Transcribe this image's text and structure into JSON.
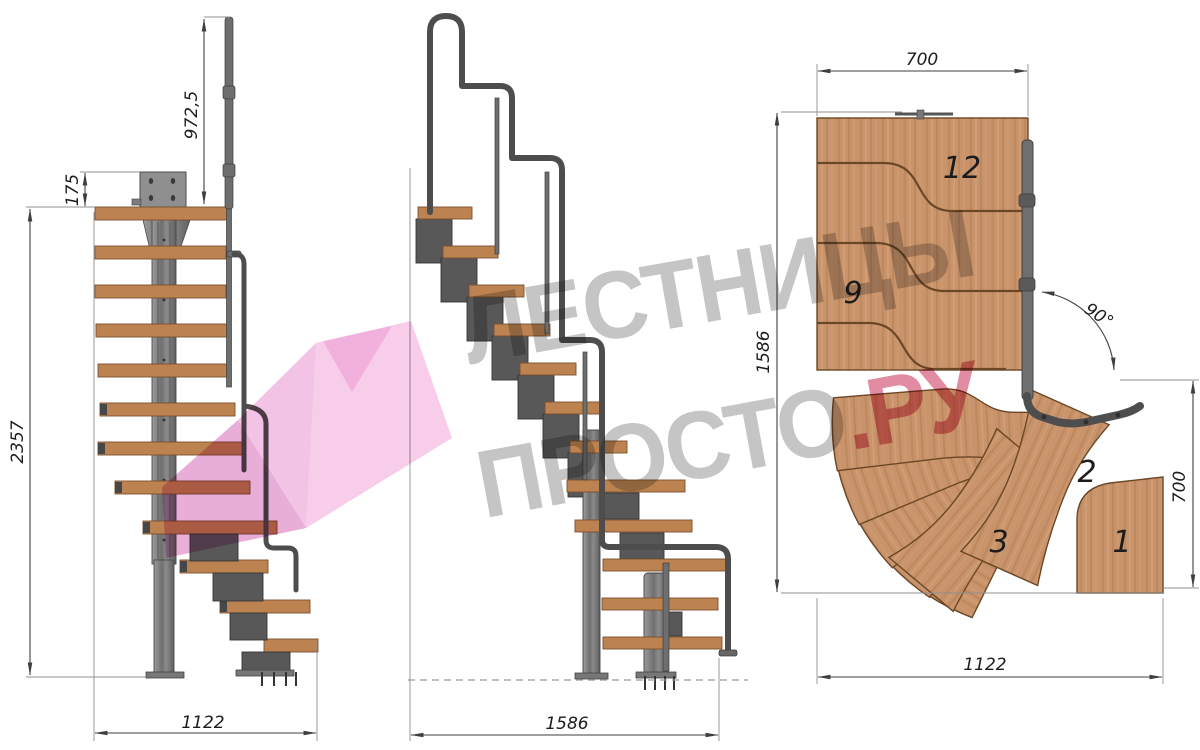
{
  "watermark": {
    "line1": "ЛЕСТНИЦЫ",
    "line2": "ПРОСТО",
    "suffix": ".РУ",
    "text_color": "#8f8f8f",
    "accent_color": "#cf4568",
    "arrow_color": "#ec9ed6"
  },
  "front_view": {
    "dim_handrail_height": "972,5",
    "dim_plate_height": "175",
    "dim_total_height": "2357",
    "dim_width": "1122"
  },
  "side_view": {
    "dim_length": "1586"
  },
  "plan_view": {
    "dim_width_top": "700",
    "dim_depth_left": "1586",
    "dim_angle": "90°",
    "dim_width_right": "700",
    "dim_length_bottom": "1122",
    "step_numbers": {
      "n12": "12",
      "n9": "9",
      "n3": "3",
      "n2": "2",
      "n1": "1"
    }
  }
}
